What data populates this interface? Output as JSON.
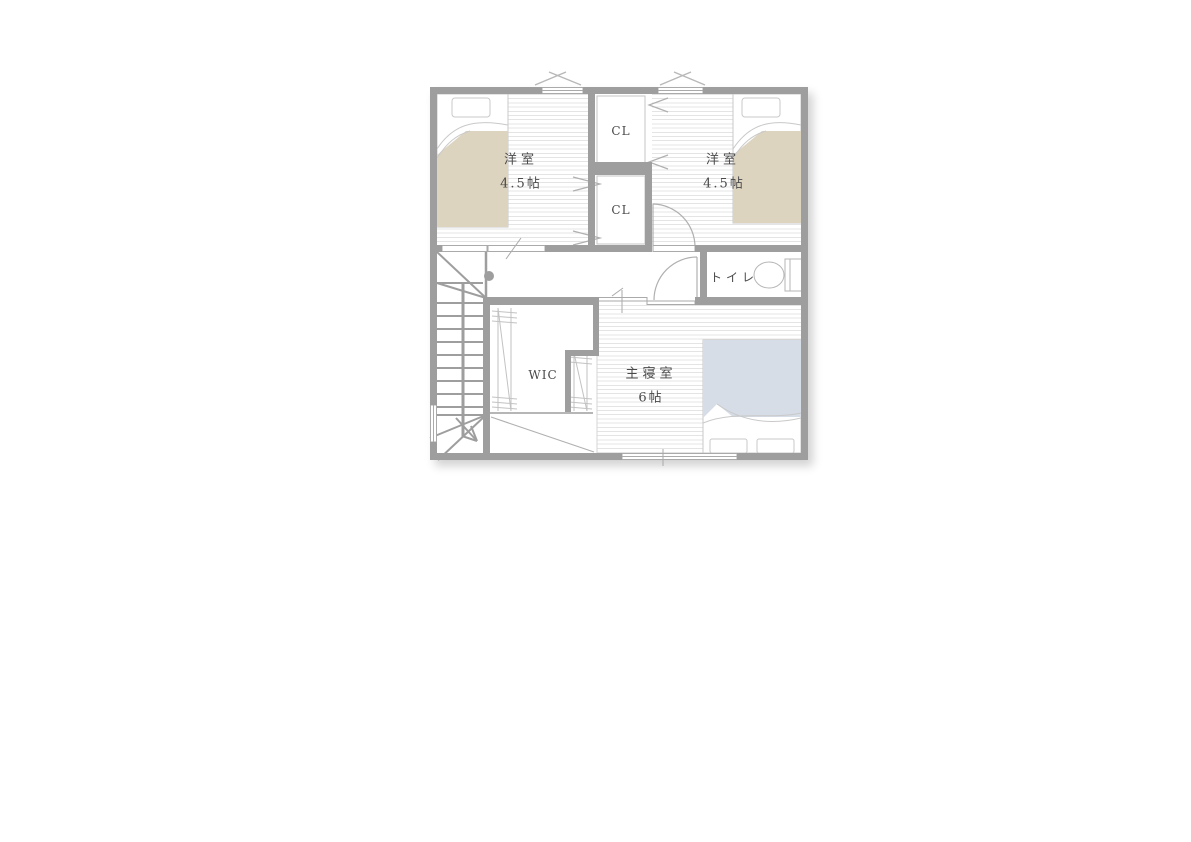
{
  "floor_plan": {
    "rooms": [
      {
        "id": "west-bedroom",
        "label": "洋室",
        "area": "4.5帖"
      },
      {
        "id": "east-bedroom",
        "label": "洋室",
        "area": "4.5帖"
      },
      {
        "id": "closet-upper",
        "label": "CL"
      },
      {
        "id": "closet-lower",
        "label": "CL"
      },
      {
        "id": "toilet",
        "label": "トイレ"
      },
      {
        "id": "walk-in-closet",
        "label": "WIC"
      },
      {
        "id": "master-bedroom",
        "label": "主寝室",
        "area": "6帖"
      }
    ],
    "colors": {
      "wall": "#9e9e9e",
      "floor_hatch": "#e4e4e4",
      "single_bed_blanket": "#ddd4c0",
      "double_bed_blanket": "#d6dde6",
      "symbol_line": "#b0b0b0",
      "text": "#4a4a4a"
    }
  }
}
